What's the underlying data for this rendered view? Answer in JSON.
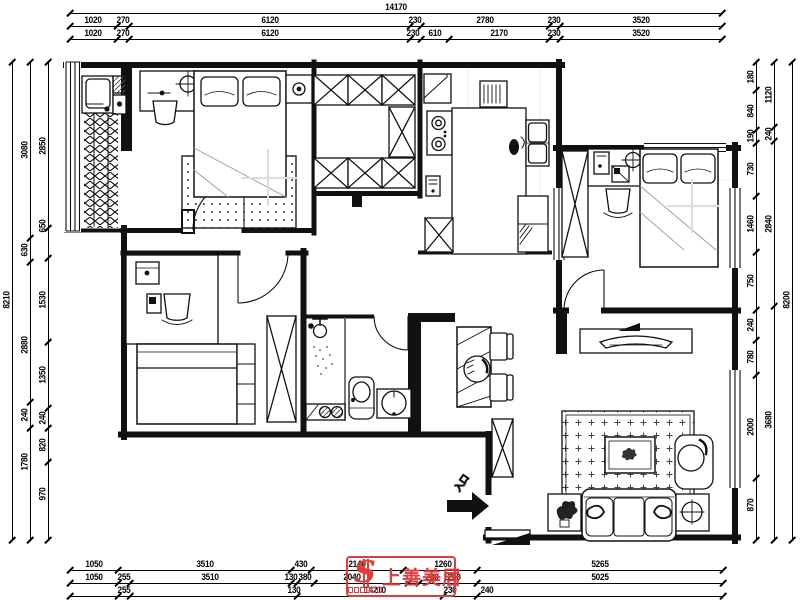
{
  "entry": {
    "label": "入口"
  },
  "watermark": {
    "logo_letter": "S",
    "brand": "上善美居"
  },
  "colors": {
    "wall": "#111111",
    "watermark_red": "#e23b3b"
  },
  "dimensions": {
    "top": {
      "row1": [
        "14170"
      ],
      "row2": [
        "1020",
        "270",
        "6120",
        "230",
        "2780",
        "230",
        "3520"
      ],
      "row3": [
        "1020",
        "270",
        "6120",
        "230",
        "610",
        "2170",
        "230",
        "3520"
      ]
    },
    "bottom": {
      "row_a": [
        "1050",
        "3510",
        "430",
        "2140",
        "1260",
        "5265"
      ],
      "row_b": [
        "1050",
        "255",
        "3510",
        "130",
        "380",
        "2040",
        "230",
        "1260",
        "5025"
      ],
      "row_c": [
        "255",
        "130",
        "14210",
        "230",
        "240"
      ]
    },
    "left": {
      "outer": [
        "8210"
      ],
      "middle": [
        "3080",
        "630",
        "2880",
        "240",
        "1780"
      ],
      "inner": [
        "2850",
        "650",
        "1530",
        "1350",
        "240",
        "820",
        "970"
      ]
    },
    "right": {
      "outer": [
        "8200"
      ],
      "middle": [
        "1120",
        "240",
        "2840",
        "3680"
      ],
      "inner": [
        "180",
        "840",
        "190",
        "730",
        "1460",
        "750",
        "240",
        "780",
        "2000",
        "870"
      ]
    }
  }
}
